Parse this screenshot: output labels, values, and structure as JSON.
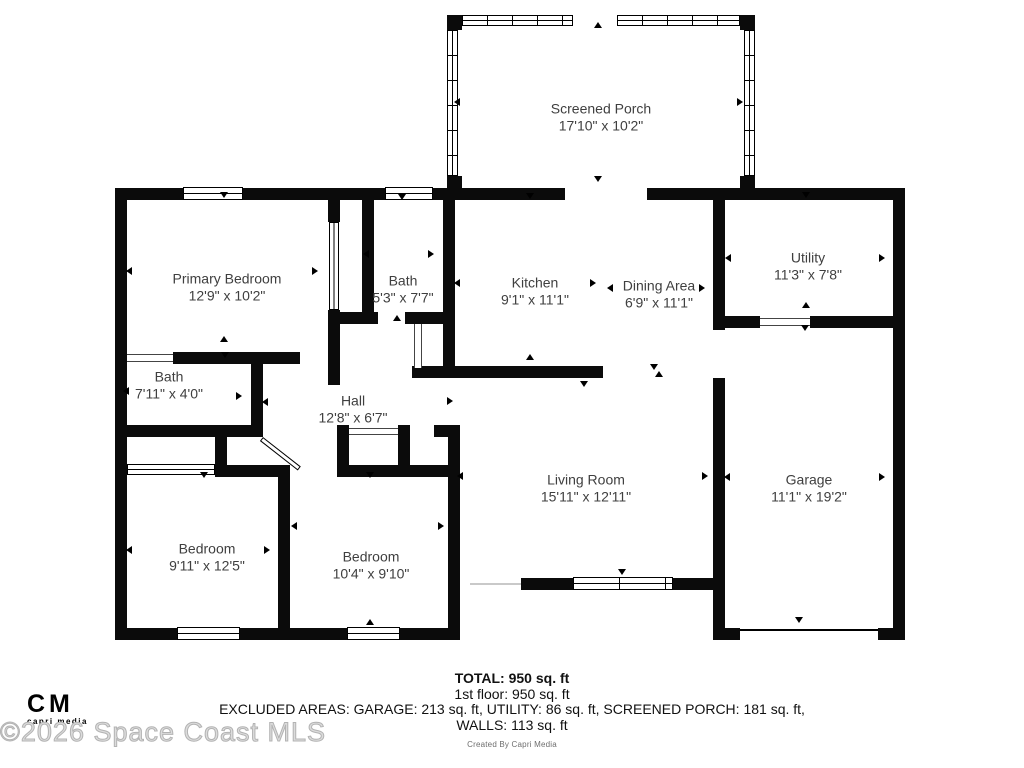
{
  "rooms": [
    {
      "name": "Screened Porch",
      "dims": "17'10\" x 10'2\""
    },
    {
      "name": "Primary Bedroom",
      "dims": "12'9\" x 10'2\""
    },
    {
      "name": "Bath",
      "dims": "5'3\" x 7'7\""
    },
    {
      "name": "Kitchen",
      "dims": "9'1\" x 11'1\""
    },
    {
      "name": "Dining Area",
      "dims": "6'9\" x 11'1\""
    },
    {
      "name": "Utility",
      "dims": "11'3\" x 7'8\""
    },
    {
      "name": "Bath",
      "dims": "7'11\" x 4'0\""
    },
    {
      "name": "Hall",
      "dims": "12'8\" x 6'7\""
    },
    {
      "name": "Living Room",
      "dims": "15'11\" x 12'11\""
    },
    {
      "name": "Garage",
      "dims": "11'1\" x 19'2\""
    },
    {
      "name": "Bedroom",
      "dims": "9'11\" x 12'5\""
    },
    {
      "name": "Bedroom",
      "dims": "10'4\" x 9'10\""
    }
  ],
  "summary": {
    "total": "TOTAL: 950 sq. ft",
    "floor": "1st floor: 950 sq. ft",
    "excluded": "EXCLUDED AREAS: GARAGE: 213 sq. ft, UTILITY: 86 sq. ft, SCREENED PORCH: 181 sq. ft,",
    "walls": "WALLS: 113 sq. ft"
  },
  "credit": "Created By Capri Media",
  "branding": {
    "logo": "CM",
    "logo_sub": "capri media",
    "watermark": "©2026 Space Coast MLS"
  },
  "colors": {
    "wall": "#0b0b0b",
    "label": "#3f3f3f",
    "watermark": "#dcdcdc"
  }
}
